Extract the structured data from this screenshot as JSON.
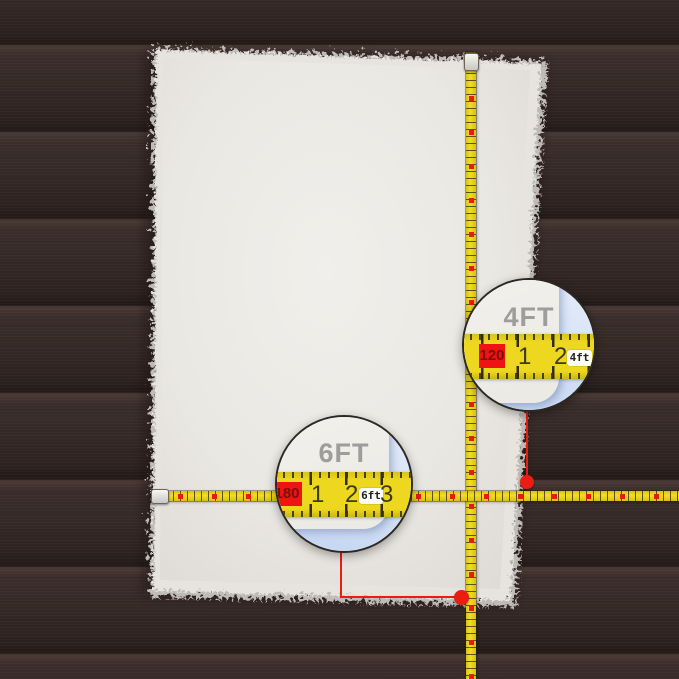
{
  "callouts": {
    "width": {
      "label": "4FT",
      "cm_mark": "120",
      "ticks": [
        "1",
        "2",
        "3"
      ],
      "unit_badge": "4ft"
    },
    "length": {
      "label": "6FT",
      "cm_mark": "180",
      "ticks": [
        "1",
        "2",
        "3"
      ],
      "unit_badge": "6ft"
    }
  },
  "colors": {
    "floor_wood": "#302522",
    "rug_white": "#ebe9e4",
    "tape_yellow": "#edd71f",
    "marker_red": "#ea1d15",
    "label_gray": "#9d9d9d",
    "magnifier_blue": "#c7d7f2"
  }
}
